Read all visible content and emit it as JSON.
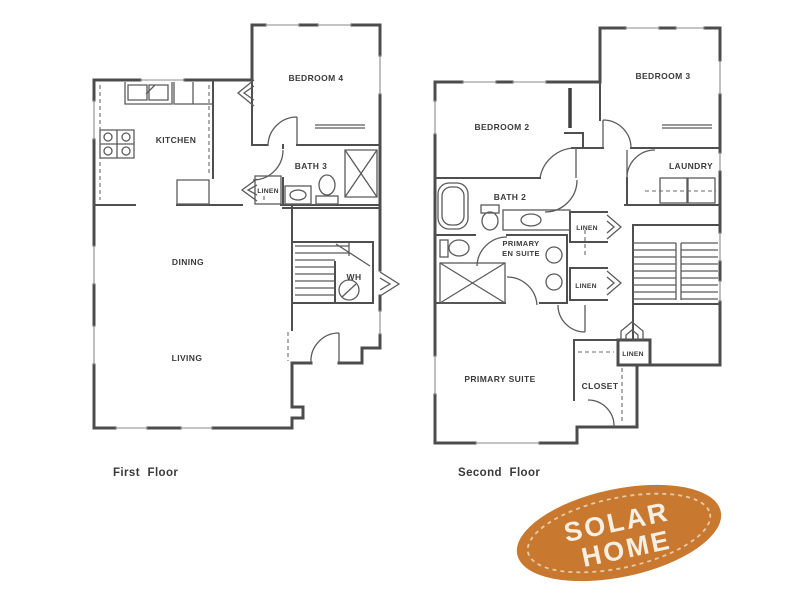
{
  "first_floor": {
    "caption": "First Floor",
    "rooms": {
      "bedroom4": "BEDROOM 4",
      "kitchen": "KITCHEN",
      "bath3": "BATH 3",
      "linen": "LINEN",
      "dining": "DINING",
      "living": "LIVING",
      "water_heater": "WH"
    }
  },
  "second_floor": {
    "caption": "Second Floor",
    "rooms": {
      "bedroom2": "BEDROOM 2",
      "bedroom3": "BEDROOM 3",
      "bath2": "BATH 2",
      "laundry": "LAUNDRY",
      "primary_en_suite_line1": "PRIMARY",
      "primary_en_suite_line2": "EN SUITE",
      "linen_hall_upper": "LINEN",
      "linen_hall_lower": "LINEN",
      "linen_closet": "LINEN",
      "primary_suite": "PRIMARY SUITE",
      "closet": "CLOSET"
    }
  },
  "badge": {
    "line1": "SOLAR",
    "line2": "HOME",
    "fill": "#c8792f",
    "stitch_color": "#ead9bd",
    "text_color": "#f6efe3"
  },
  "colors": {
    "wall": "#4c4c4c",
    "fixture": "#5b5b5b",
    "label": "#3b3b3b",
    "background": "#ffffff"
  }
}
